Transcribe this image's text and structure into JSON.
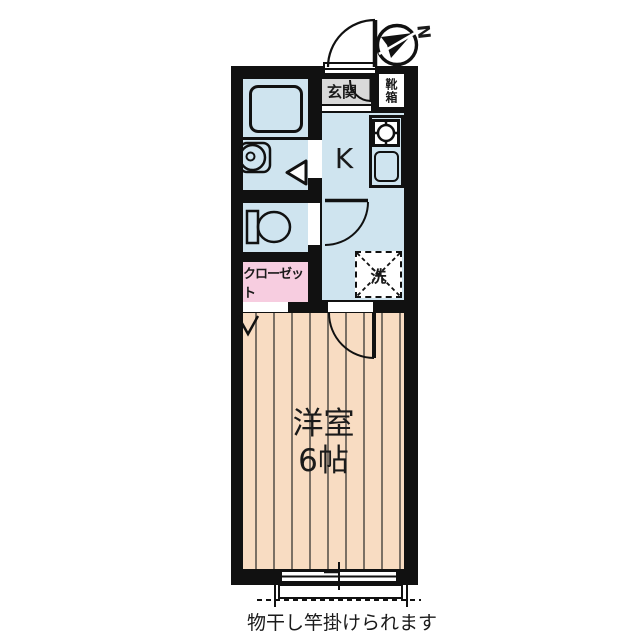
{
  "plan": {
    "compass_letter": "N",
    "entrance": {
      "label": "玄関",
      "shoebox_label": "靴箱"
    },
    "kitchen": {
      "label": "K"
    },
    "laundry": {
      "label": "洗"
    },
    "closet": {
      "label": "クローゼット"
    },
    "room": {
      "name": "洋室",
      "size": "6帖"
    },
    "balcony": {
      "note": "物干し竿掛けられます"
    }
  },
  "colors": {
    "wall": "#111111",
    "blue": "#cfe4ef",
    "peach": "#f8dcc2",
    "stripe": "#7b7065",
    "pink": "#f7cde0",
    "gray": "#d9d9d9",
    "text": "#1a1a1a"
  }
}
